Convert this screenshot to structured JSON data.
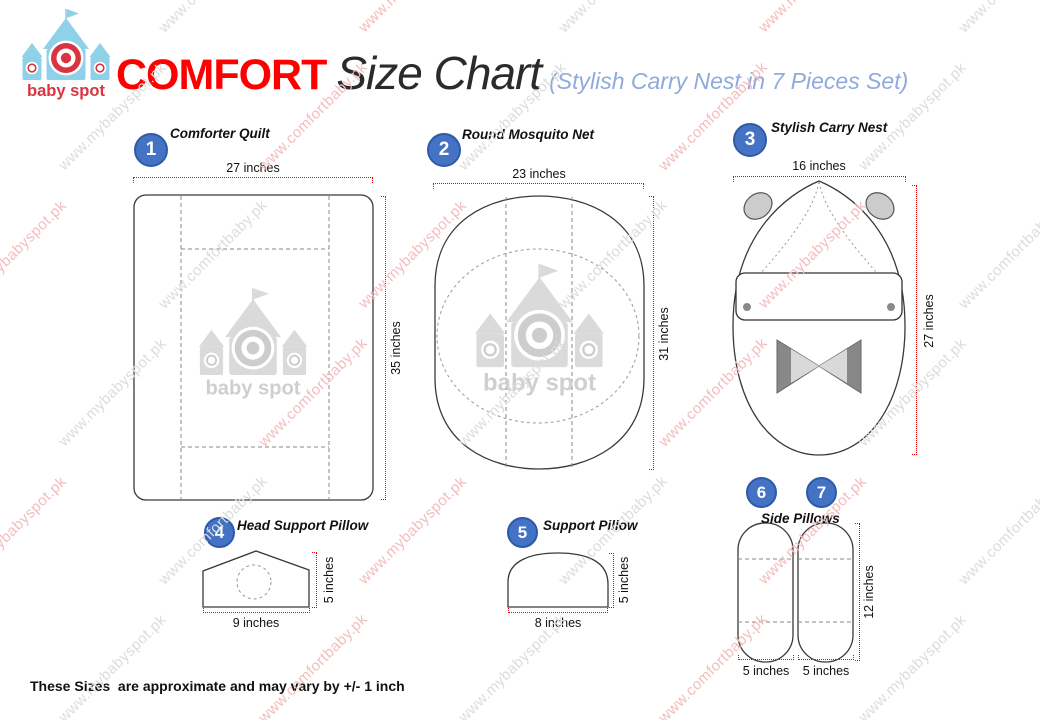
{
  "header": {
    "logo_text": "baby spot",
    "brand": "COMFORT",
    "title": "Size Chart",
    "subtitle": "(Stylish Carry Nest in 7 Pieces Set)"
  },
  "items": [
    {
      "number": "1",
      "label": "Comforter Quilt",
      "width_label": "27 inches",
      "height_label": "35 inches"
    },
    {
      "number": "2",
      "label": "Round Mosquito Net",
      "width_label": "23 inches",
      "height_label": "31 inches"
    },
    {
      "number": "3",
      "label": "Stylish Carry Nest",
      "width_label": "16 inches",
      "height_label": "27 inches"
    },
    {
      "number": "4",
      "label": "Head Support Pillow",
      "width_label": "9 inches",
      "height_label": "5 inches"
    },
    {
      "number": "5",
      "label": "Support Pillow",
      "width_label": "8 inches",
      "height_label": "5 inches"
    },
    {
      "numbers": [
        "6",
        "7"
      ],
      "label": "Side Pillows",
      "width_labels": [
        "5 inches",
        "5 inches"
      ],
      "height_label": "12 inches"
    }
  ],
  "footnote": "These Sizes  are approximate and may vary by +/- 1 inch",
  "watermark": {
    "texts": [
      "www.mybabyspot.pk",
      "www.comfortbaby.pk"
    ],
    "colors": [
      "#f2bdbd",
      "#dcdcdc"
    ]
  },
  "colors": {
    "brand_red": "#ff0000",
    "badge_blue": "#4472c4",
    "badge_border": "#2e5aa8",
    "dimension_red": "#f00000",
    "subtitle_blue": "#8faadc",
    "logo_blue": "#8fd1e8",
    "logo_red": "#d93540",
    "sketch_gray": "#d8d8d8"
  }
}
